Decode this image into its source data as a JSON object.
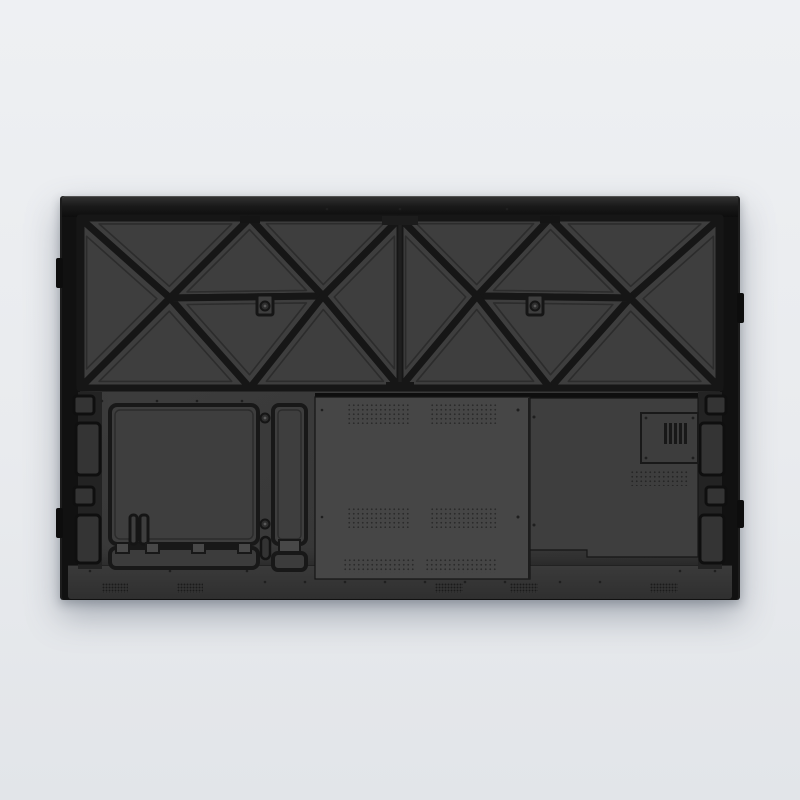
{
  "meta": {
    "type": "product-photo",
    "alt": "Rear view of a wall-mountable interactive flat panel display with stamped truss-reinforced back cover",
    "width_px": 800,
    "height_px": 800
  },
  "colors": {
    "bg-top": "#eef0f3",
    "bg-mid": "#e9ebee",
    "bg-bottom": "#e2e5e9",
    "frame": "#111111",
    "recess": "#3b3b3b",
    "groove": "#161616",
    "face": "#3e3e3e",
    "cover-a": "#464646",
    "cover-b": "#3e3e3e",
    "strip": "#363636"
  },
  "parts": {
    "panel": {
      "label": "Display rear panel"
    },
    "truss": {
      "label": "Stamped reinforcement truss pattern"
    },
    "boss_left": {
      "label": "Wall-mount screw boss left"
    },
    "boss_right": {
      "label": "Wall-mount screw boss right"
    },
    "access_left": {
      "label": "Left access panel"
    },
    "slim_panel": {
      "label": "Narrow access panel"
    },
    "rail_left": {
      "label": "Bottom mounting rail"
    },
    "cover_main": {
      "label": "Main electronics cover"
    },
    "cover_right": {
      "label": "Power board cover"
    },
    "vent": {
      "label": "Ventilation module"
    },
    "strip": {
      "label": "Bottom connector strip"
    },
    "grille": {
      "label": "Speaker grille"
    },
    "handles": {
      "label": "Side handle cutouts"
    }
  }
}
